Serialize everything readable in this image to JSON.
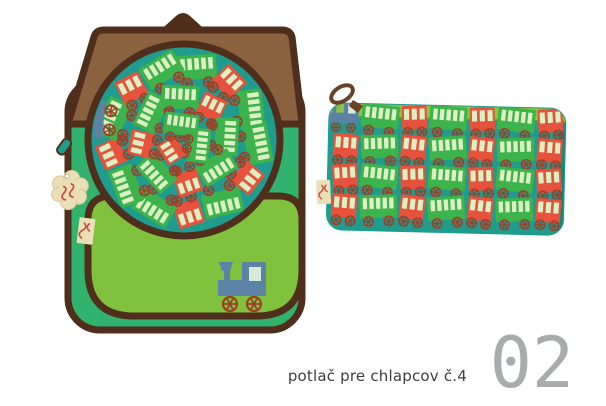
{
  "caption": {
    "text": "potlač pre chlapcov č.4",
    "number": "02"
  },
  "palette": {
    "teal": "#1f9c8d",
    "emerald": "#31b26d",
    "pocket_green": "#80c13e",
    "strip_green": "#8cc63f",
    "strip_green_dark": "#58a32e",
    "flap_brown": "#8a6240",
    "dark_brown": "#4f2e1b",
    "wagon_green": "#3db34b",
    "wagon_red": "#e7523c",
    "window_pale": "#ddf0c4",
    "wheel_brown": "#9c402a",
    "loco_blue": "#5c82a6",
    "loco_window": "#d9ead8",
    "tag_beige": "#eadfb6",
    "tag_red": "#cc4b40",
    "case_edge_dark": "#17897b",
    "pull_brown": "#6b4226",
    "caption_text": "#3d3d3d",
    "number_gray": "#a9abac"
  },
  "artwork": {
    "circle_pattern": {
      "rings": [
        {
          "radius": 74,
          "count": 13,
          "start_angle": -80,
          "scale": 0.82,
          "colors": [
            "green",
            "red",
            "green",
            "green",
            "red",
            "green",
            "red",
            "green",
            "green",
            "red",
            "green",
            "red",
            "green"
          ]
        },
        {
          "radius": 43,
          "count": 8,
          "start_angle": -50,
          "scale": 0.78,
          "colors": [
            "red",
            "green",
            "green",
            "red",
            "green",
            "red",
            "green",
            "green"
          ]
        },
        {
          "radius": 16,
          "count": 3,
          "start_angle": 20,
          "scale": 0.72,
          "colors": [
            "green",
            "red",
            "green"
          ]
        }
      ],
      "loco": {
        "x": 60,
        "y": 112,
        "rotation": -85,
        "scale": 0.8
      }
    },
    "pencil_case_pattern": {
      "row_y": [
        38,
        68,
        98,
        128
      ],
      "col_x": [
        30,
        64,
        98,
        132,
        166,
        200,
        234
      ],
      "rows": [
        [
          "loco",
          "green",
          "red",
          "green",
          "red",
          "green",
          "red"
        ],
        [
          "red",
          "green",
          "red",
          "green",
          "red",
          "green",
          "red"
        ],
        [
          "red",
          "green",
          "red",
          "green",
          "red",
          "green",
          "red"
        ],
        [
          "red",
          "green",
          "red",
          "green",
          "red",
          "green",
          "red"
        ]
      ]
    }
  }
}
